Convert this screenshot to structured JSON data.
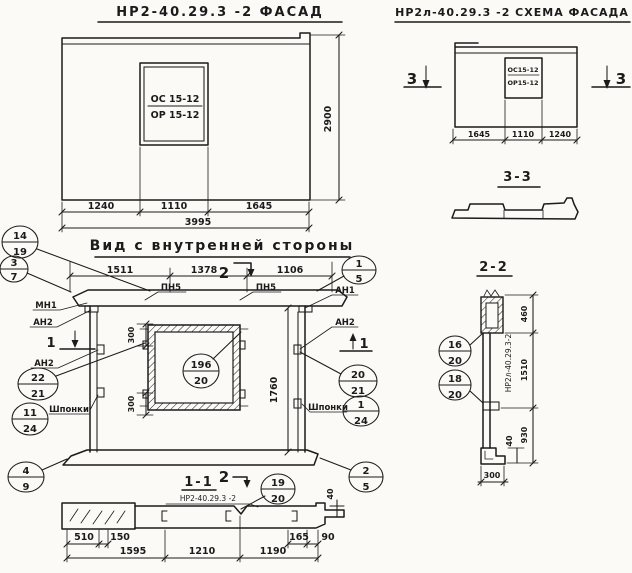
{
  "colors": {
    "paper": "#fbfaf7",
    "ink": "#1b1b1b"
  },
  "facade": {
    "title": "НР2-40.29.3 -2 ФАСАД",
    "window_mark_top": "ОС 15-12",
    "window_mark_bottom": "ОР 15-12",
    "dim_1240": "1240",
    "dim_1110": "1110",
    "dim_1645": "1645",
    "dim_total": "3995",
    "dim_height": "2900"
  },
  "schema": {
    "title": "НР2л-40.29.3 -2 СХЕМА ФАСАДА",
    "window_mark_top": "ОС15-12",
    "window_mark_bottom": "ОР15-12",
    "dim_1645": "1645",
    "dim_1110": "1110",
    "dim_1240": "1240",
    "mark_left": "3",
    "mark_right": "3"
  },
  "section33": {
    "title": "3-3"
  },
  "inner": {
    "title": "Вид с внутренней стороны",
    "dim_1511": "1511",
    "dim_1378": "1378",
    "dim_1106": "1106",
    "dim_300_top": "300",
    "dim_300_bottom": "300",
    "dim_1760": "1760",
    "label_pn5_left": "ПН5",
    "label_pn5_right": "ПН5",
    "label_mn1": "МН1",
    "label_an2_left_top": "АН2",
    "label_an2_left_bottom": "АН2",
    "label_an1": "АН1",
    "label_an2_right": "АН2",
    "label_keys_left": "Шпонки",
    "label_keys_right": "Шпонки",
    "mark_1_left": "1",
    "mark_1_right": "1",
    "mark_2_top": "2",
    "mark_2_bottom": "2"
  },
  "section11": {
    "title": "1-1",
    "stamp": "НР2-40.29.3 -2",
    "dim_510": "510",
    "dim_150": "150",
    "dim_1595": "1595",
    "dim_1210": "1210",
    "dim_1190": "1190",
    "dim_165": "165",
    "dim_90": "90",
    "dim_40": "40"
  },
  "section22": {
    "title": "2-2",
    "stamp": "НР2л-40.29.3-2",
    "dim_460": "460",
    "dim_1510": "1510",
    "dim_930": "930",
    "dim_40": "40",
    "dim_300": "300"
  },
  "callouts": {
    "c14_19": {
      "top": "14",
      "bottom": "19"
    },
    "c3_7": {
      "top": "3",
      "bottom": "7"
    },
    "c1_5": {
      "top": "1",
      "bottom": "5"
    },
    "c22_21": {
      "top": "22",
      "bottom": "21"
    },
    "c11_24": {
      "top": "11",
      "bottom": "24"
    },
    "c4_9": {
      "top": "4",
      "bottom": "9"
    },
    "c20_21": {
      "top": "20",
      "bottom": "21"
    },
    "c1_24": {
      "top": "1",
      "bottom": "24"
    },
    "c2_5": {
      "top": "2",
      "bottom": "5"
    },
    "c196_20": {
      "top": "196",
      "bottom": "20"
    },
    "c19_20": {
      "top": "19",
      "bottom": "20"
    },
    "c16_20": {
      "top": "16",
      "bottom": "20"
    },
    "c18_20": {
      "top": "18",
      "bottom": "20"
    }
  }
}
